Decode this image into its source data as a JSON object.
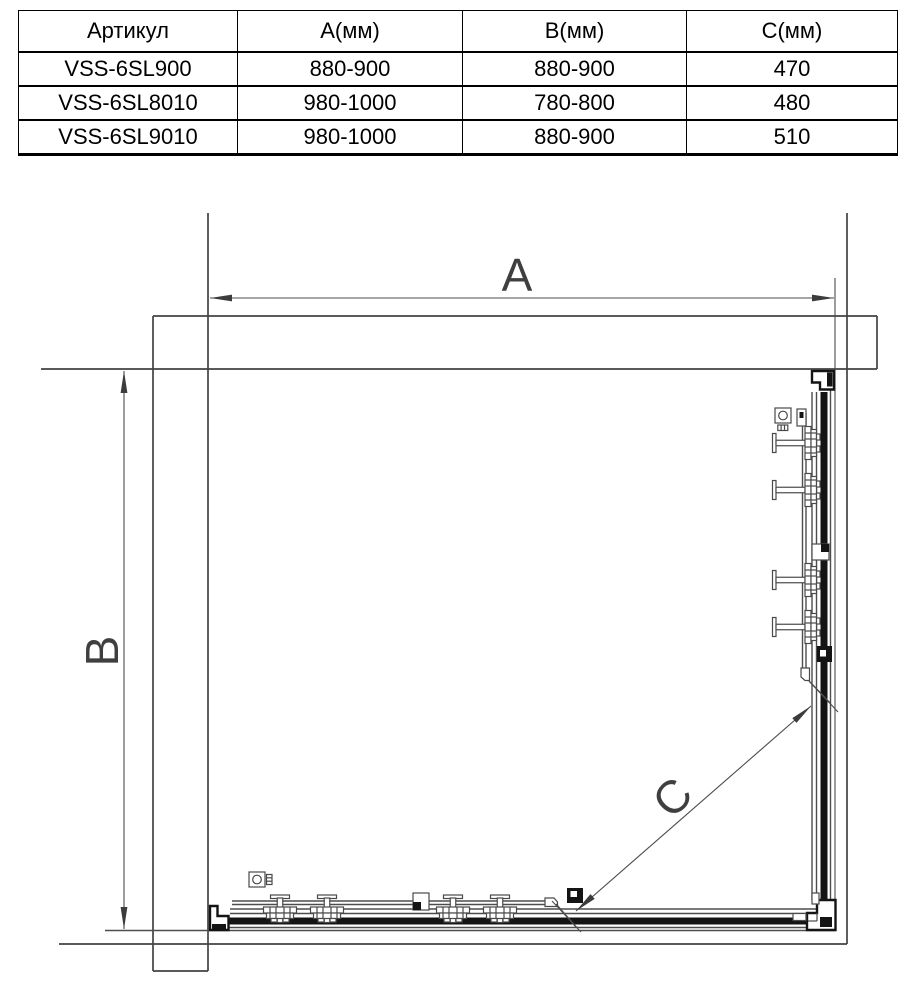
{
  "table": {
    "columns": [
      "Артикул",
      "А(мм)",
      "В(мм)",
      "С(мм)"
    ],
    "rows": [
      {
        "article": "VSS-6SL900",
        "a": "880-900",
        "b": "880-900",
        "c": "470"
      },
      {
        "article": "VSS-6SL8010",
        "a": "980-1000",
        "b": "780-800",
        "c": "480"
      },
      {
        "article": "VSS-6SL9010",
        "a": "980-1000",
        "b": "880-900",
        "c": "510"
      }
    ]
  },
  "diagram": {
    "dim_width_label": "A",
    "dim_depth_label": "B",
    "dim_entry_label": "C"
  },
  "colors": {
    "line": "#4d4d4d",
    "thick_parts": "#141414",
    "dim_text": "#3f3f3f",
    "table_border": "#000000",
    "background": "#ffffff"
  }
}
